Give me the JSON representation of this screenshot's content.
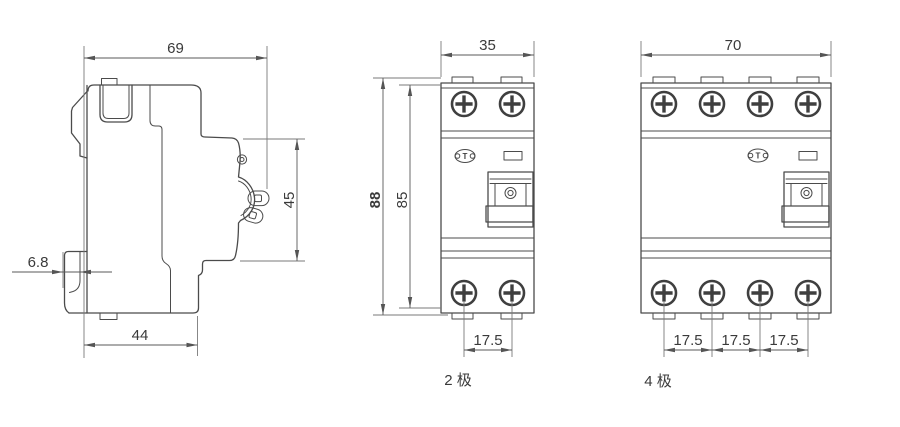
{
  "drawing": {
    "background_color": "#ffffff",
    "outline_color": "#4b4b4b",
    "dimension_color": "#5a5a5a",
    "text_color": "#3a3a3a",
    "views": {
      "side": {
        "dim_overall_width": "69",
        "dim_terminal_height": "45",
        "dim_clip_depth": "6.8",
        "dim_base_width": "44"
      },
      "two_pole": {
        "label": "2 极",
        "dim_width": "35",
        "dim_overall_height": "88",
        "dim_body_height": "85",
        "dim_pole_pitch": "17.5",
        "logo_text": "T"
      },
      "four_pole": {
        "label": "4 极",
        "dim_width": "70",
        "dim_pole_pitches": [
          "17.5",
          "17.5",
          "17.5"
        ],
        "logo_text": "T"
      }
    }
  }
}
